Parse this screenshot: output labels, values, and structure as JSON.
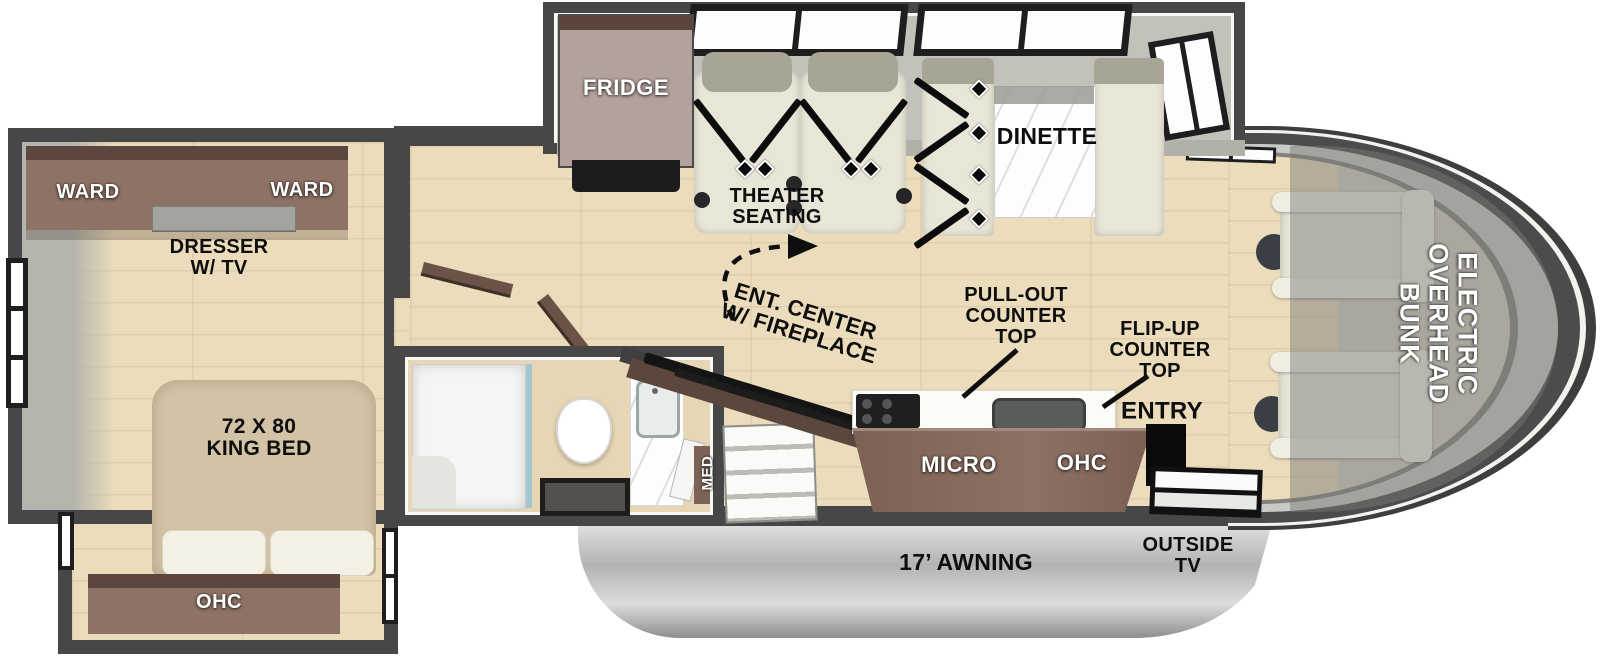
{
  "title": "RV floor plan",
  "palette": {
    "wall": "#474747",
    "floor_wood": "#ebdcbc",
    "cabinet_brown": "#8a7064",
    "cabinet_dark": "#5c463e",
    "furniture_cream": "#e9e6d8",
    "fridge_tan": "#b3a19b",
    "awning_gray": "#bdbdbd",
    "label_black": "#0e0e0e",
    "label_white": "#ffffff"
  },
  "labels": {
    "ward_left": "WARD",
    "ward_right": "WARD",
    "dresser_tv": "DRESSER\nW/ TV",
    "king_bed": "72 X 80\nKING BED",
    "bedroom_ohc": "OHC",
    "washer_dryer": "WASHER/\nDRYER\nPREP",
    "fridge": "FRIDGE",
    "theater_seating": "THEATER\nSEATING",
    "dinette": "DINETTE",
    "ent_center": "ENT. CENTER\nW/ FIREPLACE",
    "pull_out": "PULL-OUT\nCOUNTER\nTOP",
    "flip_up": "FLIP-UP\nCOUNTER\nTOP",
    "entry": "ENTRY",
    "micro": "MICRO",
    "kitchen_ohc": "OHC",
    "med": "MED",
    "overhead_bunk": "ELECTRIC\nOVERHEAD\nBUNK",
    "awning": "17’ AWNING",
    "outside_tv": "OUTSIDE\nTV"
  }
}
